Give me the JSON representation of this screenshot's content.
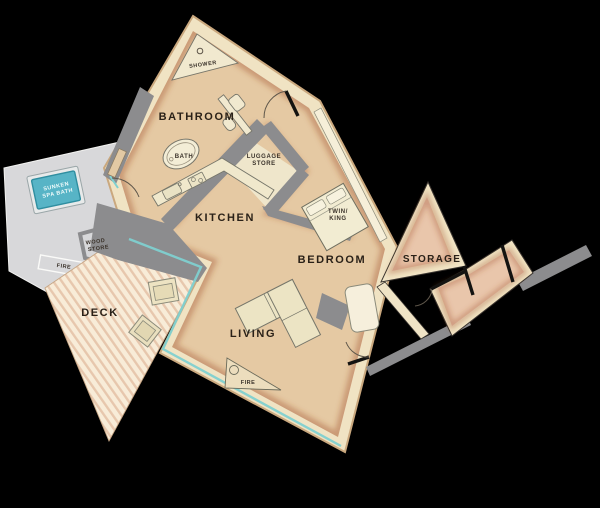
{
  "title": "cabin-floor-plan",
  "background_color": "#000000",
  "colors": {
    "floor_tan": "#e5c9a3",
    "wall_band_cream": "#f0e3c3",
    "wall_gray": "#8c8c8e",
    "platform_gray": "#d8d8da",
    "spa_teal": "#57b4c6",
    "glass_teal": "#7fd0d0",
    "deck_base": "#f8ecd8",
    "deck_stripe": "#e7c7ad",
    "furniture_cream": "#f1e9cf",
    "storage_floor": "#e9c6ab",
    "door_black": "#141311",
    "label_dark": "#2a2118",
    "spa_label_white": "#f0fbfb"
  },
  "rooms": {
    "bathroom": "BATHROOM",
    "kitchen": "KITCHEN",
    "living": "LIVING",
    "bedroom": "BEDROOM",
    "storage": "STORAGE",
    "deck": "DECK"
  },
  "fixtures": {
    "shower": "SHOWER",
    "bath": "BATH",
    "luggage_line1": "LUGGAGE",
    "luggage_line2": "STORE",
    "bed_line1": "TWIN/",
    "bed_line2": "KING",
    "fire_living": "FIRE",
    "fire_platform": "FIRE",
    "wood_line1": "WOOD",
    "wood_line2": "STORE",
    "spa_line1": "SUNKEN",
    "spa_line2": "SPA BATH"
  }
}
